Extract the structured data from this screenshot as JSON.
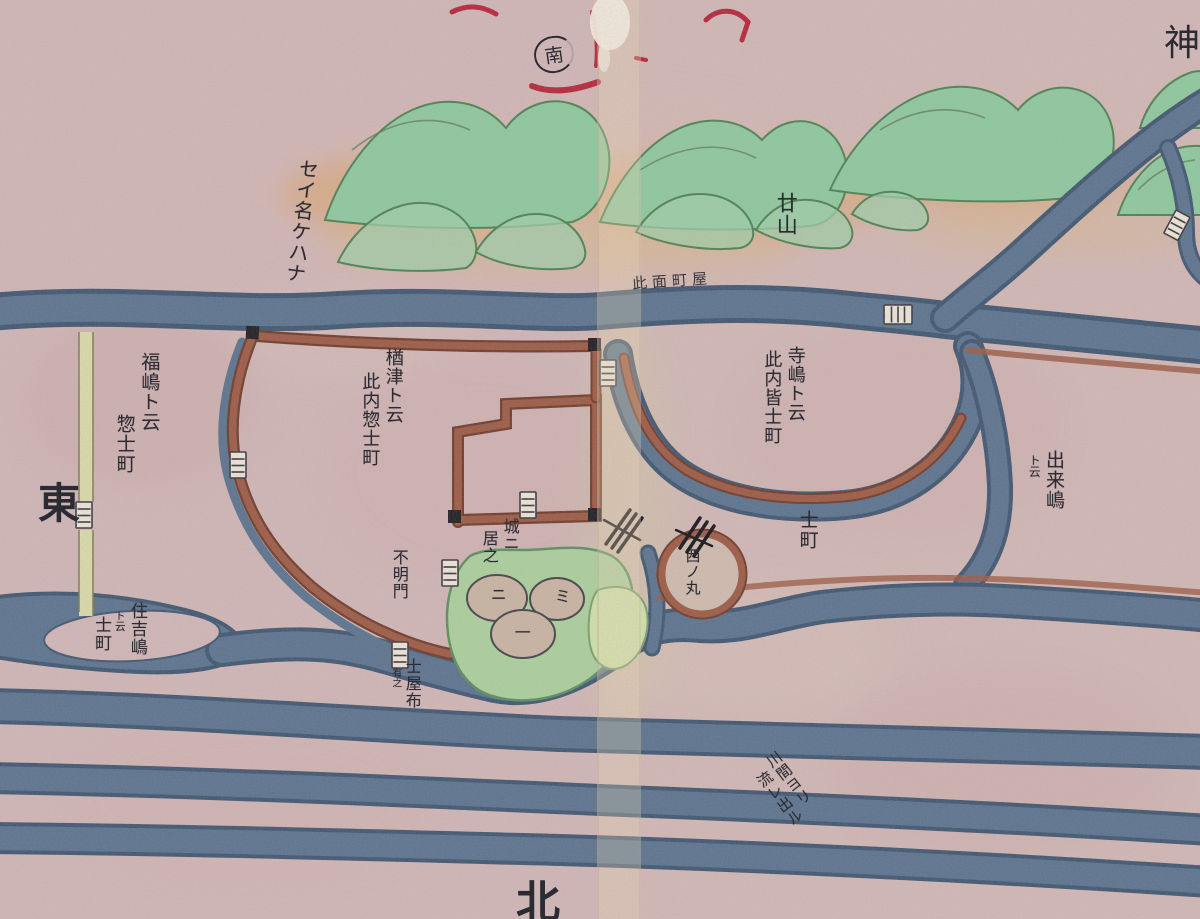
{
  "map_type": "hand-drawn Edo-period castle town map (watercolor on washi paper)",
  "compass": {
    "east": "東",
    "north": "北",
    "top_mark": "南"
  },
  "edge_char": "神",
  "labels": {
    "cape": "セイ名ケハナ",
    "hill": "廿山",
    "riverside_note": "此面町屋",
    "fukushima": {
      "name": "福嶋ト云",
      "desc": "惣士町"
    },
    "narazu": {
      "name": "楢津ト云",
      "desc": "此内惣士町"
    },
    "terashima": {
      "name": "寺嶋ト云",
      "desc": "此内皆士町"
    },
    "dekijima": {
      "name": "出来嶋",
      "suffix": "ト云"
    },
    "samurai_town_east": "士町",
    "castle_note": {
      "col1": "城ニ",
      "col2": "居之"
    },
    "fumei_gate": "不明門",
    "nishinomaru": "西ノ丸",
    "mounds": {
      "ni": "ニ",
      "mi": "ミ",
      "ichi": "一"
    },
    "sumiyoshi": {
      "name": "住吉嶋",
      "suffix": "ト云",
      "desc": "士町"
    },
    "shiyashiki": {
      "name": "士屋布",
      "suffix": "有之"
    },
    "river_note": {
      "col1": "川間ヨリ",
      "col2": "流レ出ル"
    }
  },
  "icons": {
    "bridge-hatch-icon": "▤",
    "gate-square-icon": "■",
    "ink-gate-icon": "✕",
    "circled-direction-mark": "◯",
    "torn-paper-patch": "▢"
  },
  "colors": {
    "paper": "#d2b9b9",
    "river": "#5a7590",
    "river_edge": "#3f5872",
    "wall": "#9c5c46",
    "wall_edge": "#6f3d2d",
    "mountain": "#8ecba0",
    "mountain_edge": "#4d8355",
    "castle_green": "#abd29e",
    "mound": "#c9b6a4",
    "ink": "#2b2b33",
    "red": "#b5273a",
    "road": "#d9ddab",
    "bridge": "#ece7da"
  }
}
